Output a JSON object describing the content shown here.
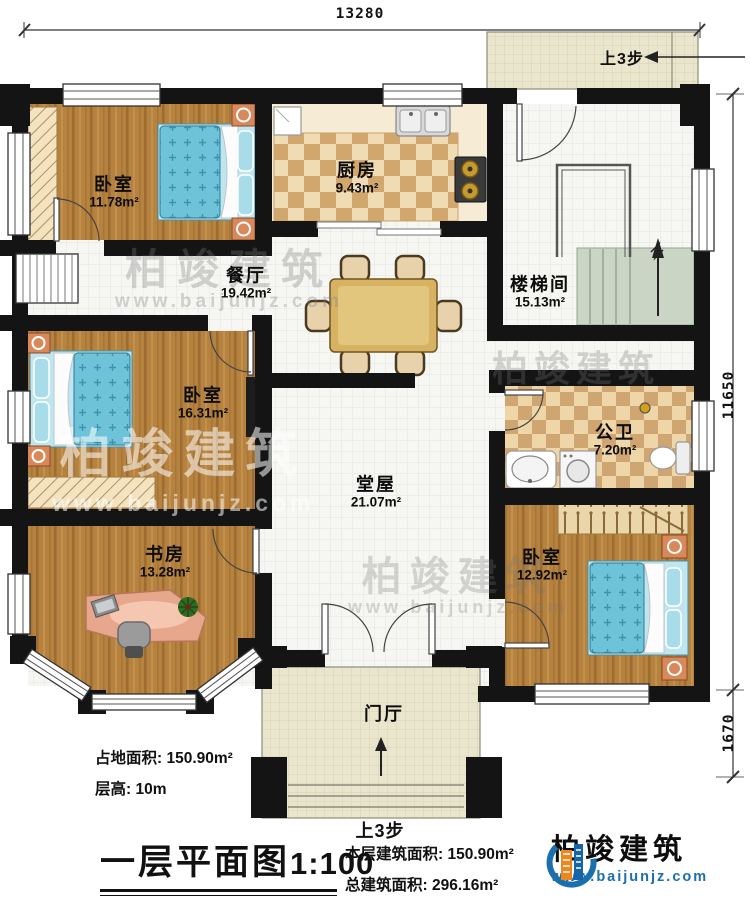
{
  "title_block": {
    "plan_title": "一层平面图",
    "plan_scale": "1:100",
    "site_area_label": "占地面积:",
    "site_area_value": "150.90m²",
    "floor_height_label": "层高:",
    "floor_height_value": "10m",
    "this_floor_area_label": "本层建筑面积:",
    "this_floor_area_value": "150.90m²",
    "total_area_label": "总建筑面积:",
    "total_area_value": "296.16m²"
  },
  "branding": {
    "company": "柏竣建筑",
    "website": "www.baijunjz.com"
  },
  "dimensions": {
    "top_width": "13280",
    "right_height": "11650",
    "right_porch": "1670"
  },
  "rooms": [
    {
      "name": "卧室",
      "area": "11.78m²"
    },
    {
      "name": "厨房",
      "area": "9.43m²"
    },
    {
      "name": "餐厅",
      "area": "19.42m²"
    },
    {
      "name": "楼梯间",
      "area": "15.13m²"
    },
    {
      "name": "卧室",
      "area": "16.31m²"
    },
    {
      "name": "堂屋",
      "area": "21.07m²"
    },
    {
      "name": "公卫",
      "area": "7.20m²"
    },
    {
      "name": "书房",
      "area": "13.28m²"
    },
    {
      "name": "卧室",
      "area": "12.92m²"
    },
    {
      "name": "门厅",
      "area": ""
    }
  ],
  "annotations": {
    "steps_up_top": "上3步",
    "steps_up_bottom": "上3步"
  },
  "watermark": {
    "text": "柏竣建筑",
    "url": "www.baijunjz.com"
  },
  "colors": {
    "wall": "#141414",
    "brand_blue": "#1a6fae",
    "brand_orange": "#f08519",
    "bed_blue": "#6fc3d9",
    "wood": "#b5823f"
  }
}
